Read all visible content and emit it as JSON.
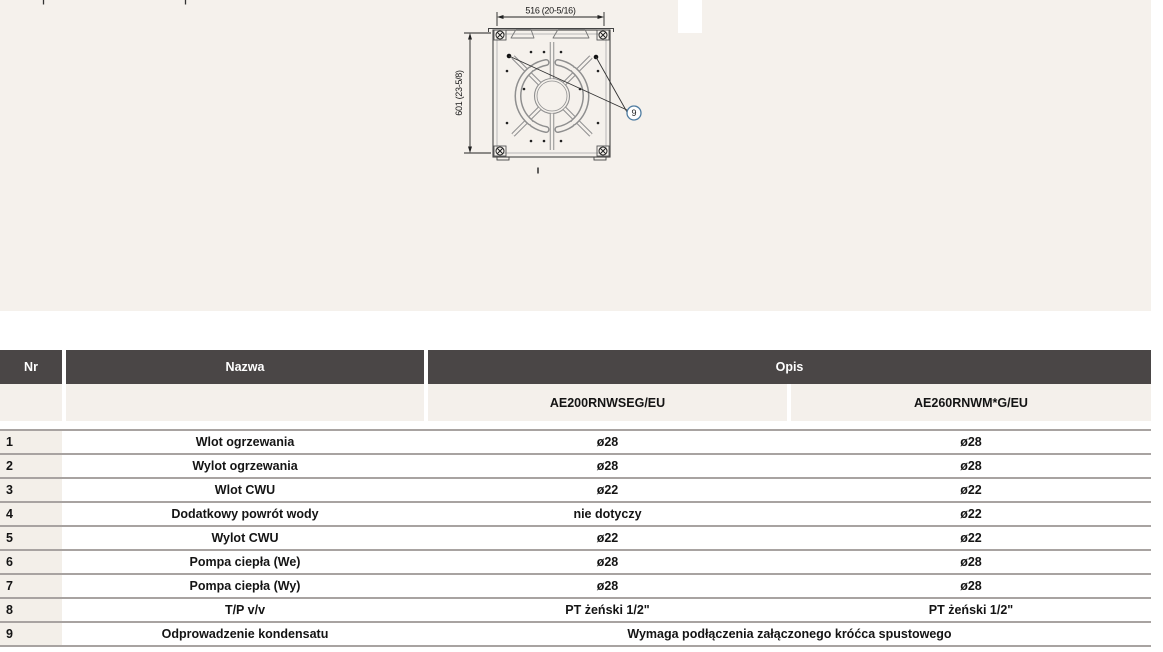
{
  "colors": {
    "band_bg": "#f5f1ec",
    "table_header_bg": "#4a4646",
    "table_header_text": "#ffffff",
    "subheader_bg": "#f4f0eb",
    "nr_cell_bg": "#f3efe9",
    "row_line": "#a8a3a1",
    "callout_stroke": "#4d7ba0",
    "diagram_gray": "#8f8f8f"
  },
  "diagram": {
    "width_label": "516 (20-5/16)",
    "height_label": "601 (23-5/8)",
    "callout": "9"
  },
  "table": {
    "header": {
      "nr": "Nr",
      "nazwa": "Nazwa",
      "opis": "Opis"
    },
    "models": [
      "AE200RNWSEG/EU",
      "AE260RNWM*G/EU"
    ],
    "rows": [
      {
        "nr": "1",
        "nazwa": "Wlot ogrzewania",
        "v1": "ø28",
        "v2": "ø28"
      },
      {
        "nr": "2",
        "nazwa": "Wylot ogrzewania",
        "v1": "ø28",
        "v2": "ø28"
      },
      {
        "nr": "3",
        "nazwa": "Wlot CWU",
        "v1": "ø22",
        "v2": "ø22"
      },
      {
        "nr": "4",
        "nazwa": "Dodatkowy powrót wody",
        "v1": "nie dotyczy",
        "v2": "ø22"
      },
      {
        "nr": "5",
        "nazwa": "Wylot CWU",
        "v1": "ø22",
        "v2": "ø22"
      },
      {
        "nr": "6",
        "nazwa": "Pompa ciepła (We)",
        "v1": "ø28",
        "v2": "ø28"
      },
      {
        "nr": "7",
        "nazwa": "Pompa ciepła (Wy)",
        "v1": "ø28",
        "v2": "ø28"
      },
      {
        "nr": "8",
        "nazwa": "T/P v/v",
        "v1": "PT żeński 1/2\"",
        "v2": "PT żeński 1/2\""
      },
      {
        "nr": "9",
        "nazwa": "Odprowadzenie kondensatu",
        "span": "Wymaga podłączenia załączonego króćca spustowego"
      }
    ]
  }
}
